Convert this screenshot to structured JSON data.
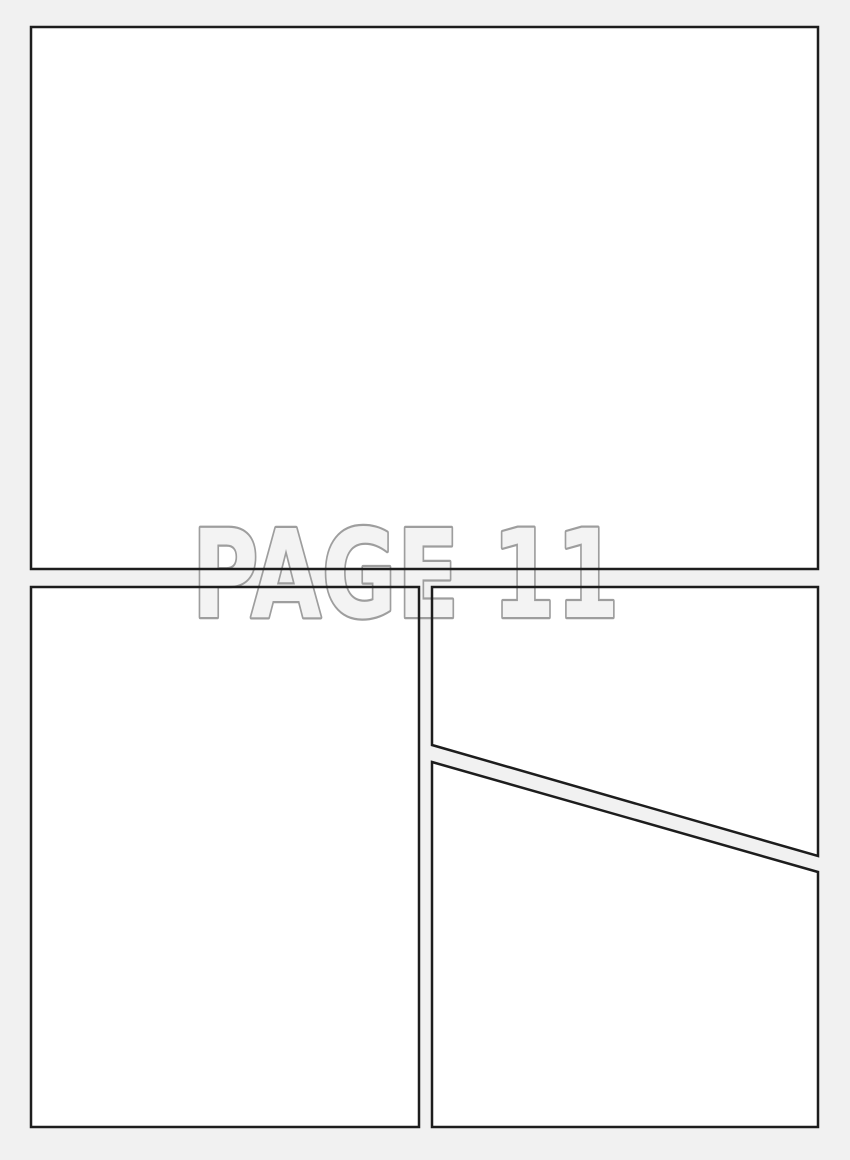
{
  "watermark": {
    "text": "PAGE 11"
  },
  "colors": {
    "page_bg": "#f1f1f1",
    "panel_fill": "#ffffff",
    "panel_border": "#1d1d1d",
    "watermark_fill": "#f3f3f3",
    "watermark_stroke": "#9e9e9e"
  }
}
